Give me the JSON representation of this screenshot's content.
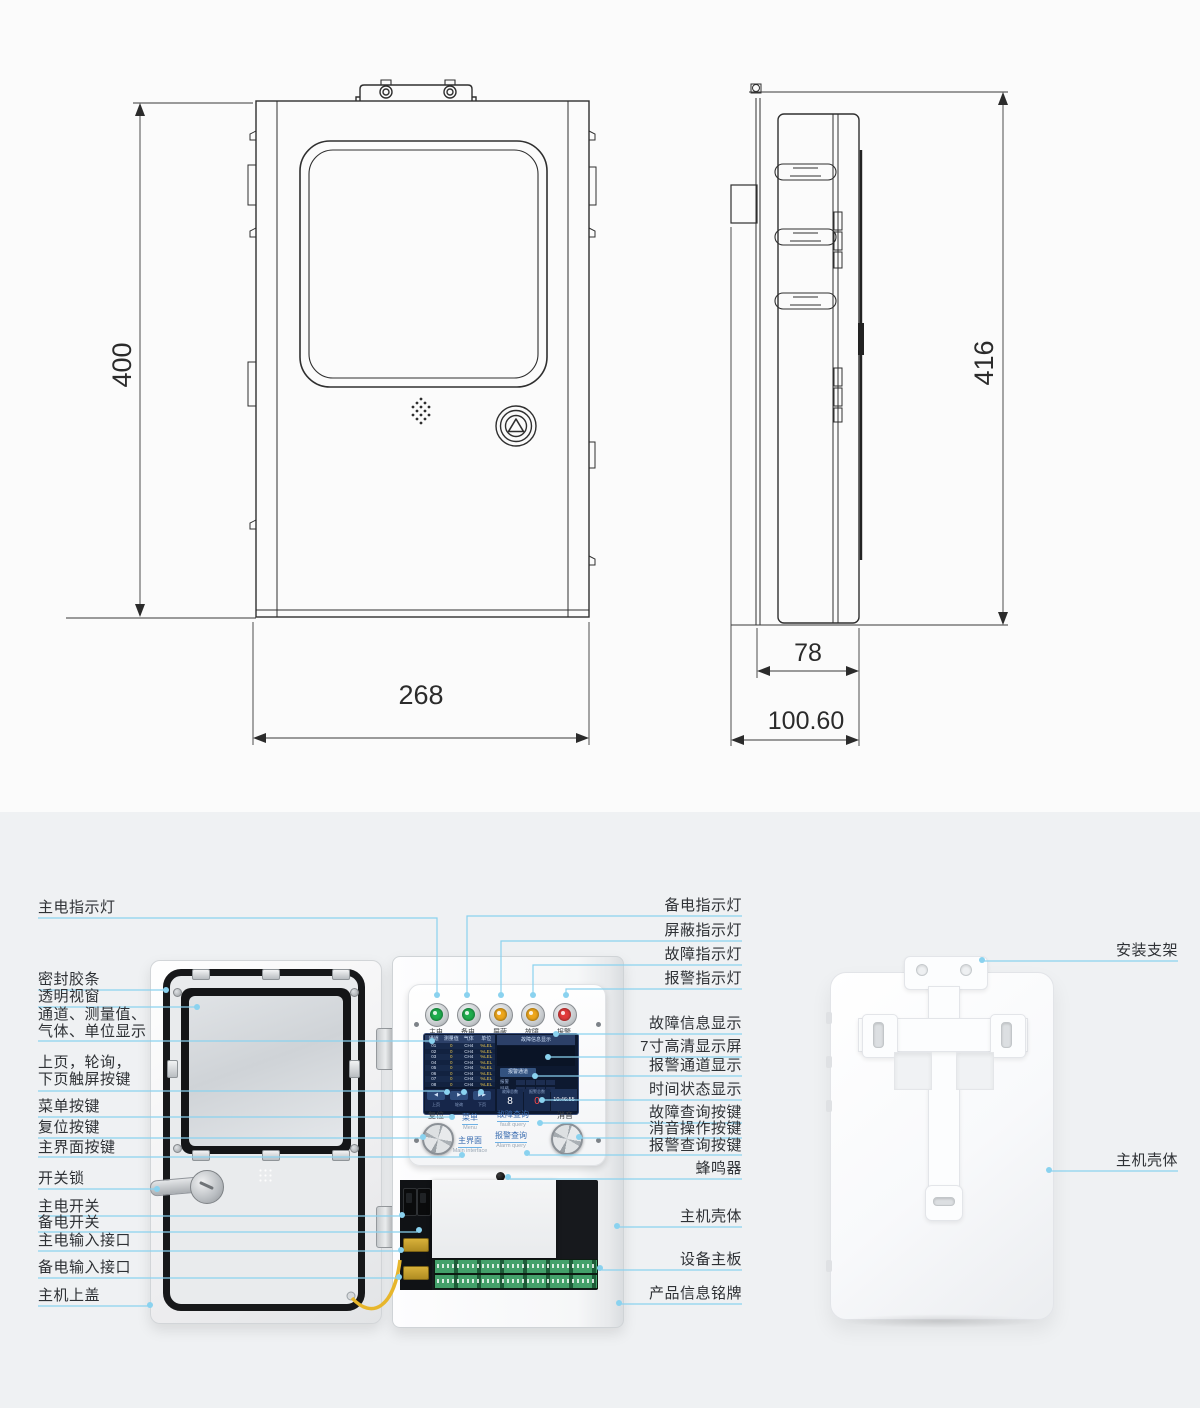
{
  "colors": {
    "leader_blue": "#8ad2ef",
    "light_green": "#1fae4e",
    "light_amber": "#eea71c",
    "light_red": "#e23b3b",
    "screen_bg": "#0d1930",
    "touch_label_blue": "#3a6cb0",
    "wire_yellow": "#e7b62c"
  },
  "dimensions": {
    "front_height": "400",
    "front_width": "268",
    "side_height": "416",
    "side_depth": "78",
    "side_depth_total": "100.60"
  },
  "callouts": {
    "left": [
      "主电指示灯",
      "密封胶条",
      "透明视窗",
      "通道、测量值、",
      "气体、单位显示",
      "上页，轮询，",
      "下页触屏按键",
      "菜单按键",
      "复位按键",
      "主界面按键",
      "开关锁",
      "主电开关",
      "备电开关",
      "主电输入接口",
      "备电输入接口",
      "主机上盖"
    ],
    "middle_right": [
      "备电指示灯",
      "屏蔽指示灯",
      "故障指示灯",
      "报警指示灯",
      "故障信息显示",
      "7寸高清显示屏",
      "报警通道显示",
      "时间状态显示",
      "故障查询按键",
      "消音操作按键",
      "报警查询按键",
      "蜂鸣器",
      "主机壳体",
      "设备主板",
      "产品信息铭牌"
    ],
    "far_right": [
      "安装支架",
      "主机壳体"
    ]
  },
  "panel": {
    "lights": [
      {
        "label": "主电",
        "color": "#1fae4e"
      },
      {
        "label": "备电",
        "color": "#1fae4e"
      },
      {
        "label": "屏蔽",
        "color": "#eea71c"
      },
      {
        "label": "故障",
        "color": "#eea71c"
      },
      {
        "label": "报警",
        "color": "#e23b3b"
      }
    ],
    "knobs": {
      "reset": "复位",
      "mute": "消音"
    },
    "touch": {
      "menu": "菜单",
      "menu_en": "Menu",
      "main": "主界面",
      "main_en": "Main interface",
      "fault": "故障查询",
      "fault_en": "fault query",
      "alarm": "报警查询",
      "alarm_en": "Alarm query"
    },
    "screen": {
      "table": {
        "headers": [
          "通道",
          "测量值",
          "气体",
          "单位"
        ],
        "rows": [
          [
            "01",
            "0",
            "CH4",
            "%LEL"
          ],
          [
            "02",
            "0",
            "CH4",
            "%LEL"
          ],
          [
            "03",
            "0",
            "CH4",
            "%LEL"
          ],
          [
            "04",
            "0",
            "CH4",
            "%LEL"
          ],
          [
            "05",
            "0",
            "CH4",
            "%LEL"
          ],
          [
            "06",
            "0",
            "CH4",
            "%LEL"
          ],
          [
            "07",
            "0",
            "CH4",
            "%LEL"
          ],
          [
            "08",
            "0",
            "CH4",
            "%LEL"
          ]
        ]
      },
      "info_title": "故障信息显示",
      "alarm_channel_btn": "报警通道",
      "side_labels": [
        "报警",
        "屏蔽"
      ],
      "nav": [
        {
          "icon": "◀",
          "label": "上页"
        },
        {
          "icon": "▶",
          "label": "轮询"
        },
        {
          "icon": "▶▶",
          "label": "下页"
        }
      ],
      "fault_total_label": "故障总数",
      "fault_total": "8",
      "alarm_total_label": "报警总数",
      "alarm_total": "0",
      "time": "10:46:55"
    }
  }
}
